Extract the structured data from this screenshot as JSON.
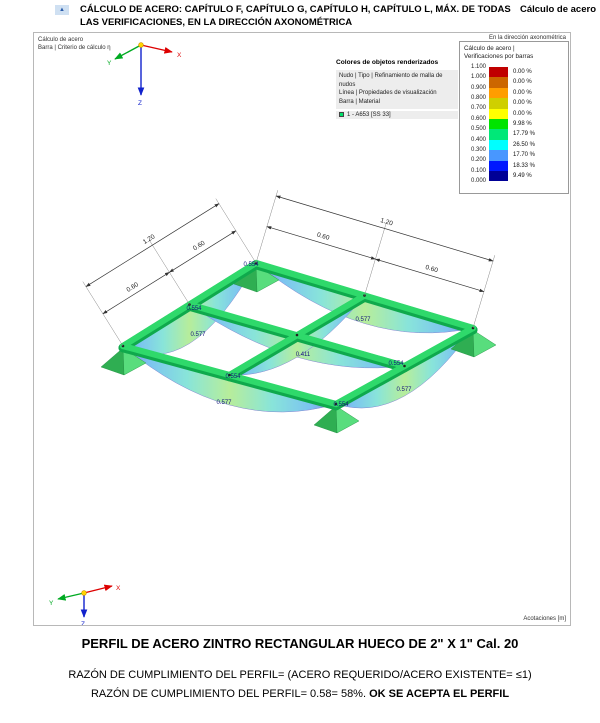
{
  "header": {
    "marker_glyph": "▲",
    "title_line1": "CÁLCULO DE ACERO: CAPÍTULO F, CAPÍTULO G, CAPÍTULO H, CAPÍTULO L, MÁX. DE TODAS",
    "title_line2": "LAS VERIFICACIONES, EN LA DIRECCIÓN AXONOMÉTRICA",
    "right_label": "Cálculo de acero"
  },
  "viewport": {
    "top_left_line1": "Cálculo de acero",
    "top_left_line2": "Barra | Criterio de cálculo η",
    "top_right_label": "En la dirección axonométrica",
    "bottom_right_label": "Acotaciones [m]"
  },
  "axes": {
    "x": "X",
    "y": "Y",
    "z": "Z"
  },
  "legend": {
    "title": "Colores de objetos renderizados",
    "lines": [
      "Nudo | Tipo | Refinamiento de malla de nudos",
      "Línea | Propiedades de visualización",
      "Barra | Material"
    ],
    "material_swatch_color": "#00e06a",
    "material_label": "1 - A653 [SS 33]"
  },
  "scale": {
    "title_line1": "Cálculo de acero |",
    "title_line2": "Verificaciones por barras",
    "ticks": [
      "1.100",
      "1.000",
      "0.900",
      "0.800",
      "0.700",
      "0.600",
      "0.500",
      "0.400",
      "0.300",
      "0.200",
      "0.100",
      "0.000"
    ],
    "bands": [
      {
        "color": "#c00000",
        "percent": "0.00 %"
      },
      {
        "color": "#cc6600",
        "percent": "0.00 %"
      },
      {
        "color": "#ff9d00",
        "percent": "0.00 %"
      },
      {
        "color": "#cfcf00",
        "percent": "0.00 %"
      },
      {
        "color": "#ffff00",
        "percent": "0.00 %"
      },
      {
        "color": "#00e400",
        "percent": "9.98 %"
      },
      {
        "color": "#00e878",
        "percent": "17.79 %"
      },
      {
        "color": "#00ffff",
        "percent": "26.50 %"
      },
      {
        "color": "#4897ff",
        "percent": "17.70 %"
      },
      {
        "color": "#0018ff",
        "percent": "18.33 %"
      },
      {
        "color": "#000096",
        "percent": "9.49 %"
      }
    ]
  },
  "model": {
    "member_color": "#2fd96b",
    "dim_left_outer": "1.20",
    "dim_left_inner_a": "0.60",
    "dim_left_inner_b": "0.60",
    "dim_right_outer": "1.20",
    "dim_right_inner_a": "0.60",
    "dim_right_inner_b": "0.60",
    "values": [
      "0.554",
      "0.577",
      "0.554",
      "0.577",
      "0.554",
      "0.411",
      "0.577",
      "0.554",
      "0.577",
      "0.554"
    ]
  },
  "captions": {
    "title": "PERFIL DE ACERO ZINTRO RECTANGULAR HUECO DE 2\" X 1\" Cal. 20",
    "line1": "RAZÓN DE CUMPLIMIENTO DEL PERFIL= (ACERO REQUERIDO/ACERO EXISTENTE= ≤1)",
    "line2_normal": "RAZÓN DE CUMPLIMIENTO DEL PERFIL= 0.58= 58%. ",
    "line2_bold": "OK SE ACEPTA EL PERFIL"
  }
}
